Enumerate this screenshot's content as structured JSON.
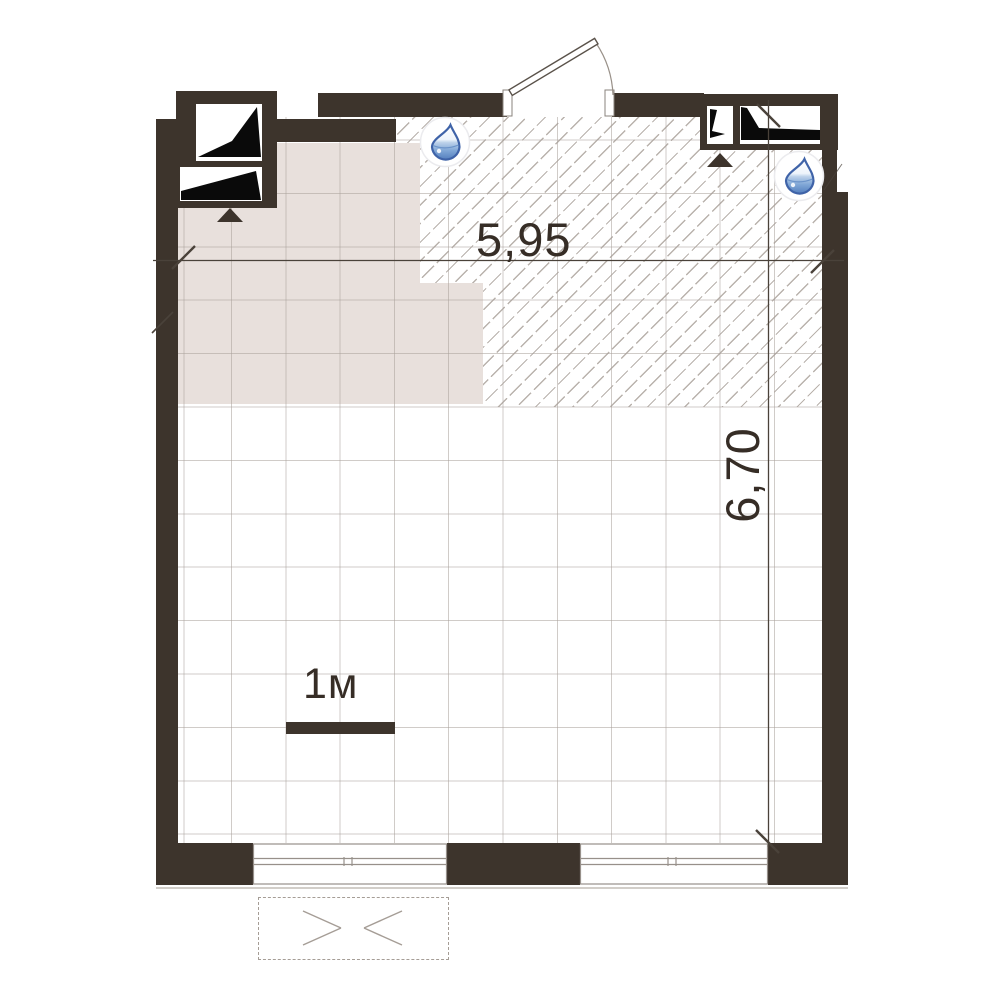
{
  "plan": {
    "type": "architectural floor plan",
    "dimensions": {
      "horizontal_label": "5,95",
      "vertical_label": "6,70"
    },
    "scale_bar": {
      "label": "1м"
    },
    "icons": {
      "water_drop": {
        "name": "water-drop-icon",
        "count": 2
      },
      "vent_arrow": {
        "name": "vent-arrow-icon",
        "count": 2
      }
    },
    "colors": {
      "wall": "#3d342c",
      "zone_fill": "#e8e0dc",
      "hatch_line": "#b9b2ac",
      "grid_line": "#a9a19b",
      "text": "#362d26",
      "line": "#4a423a",
      "frame": "#97908a",
      "dash": "#a59d96",
      "drop_outline": "#3f63a8",
      "drop_fill": "#5a85c2"
    }
  }
}
